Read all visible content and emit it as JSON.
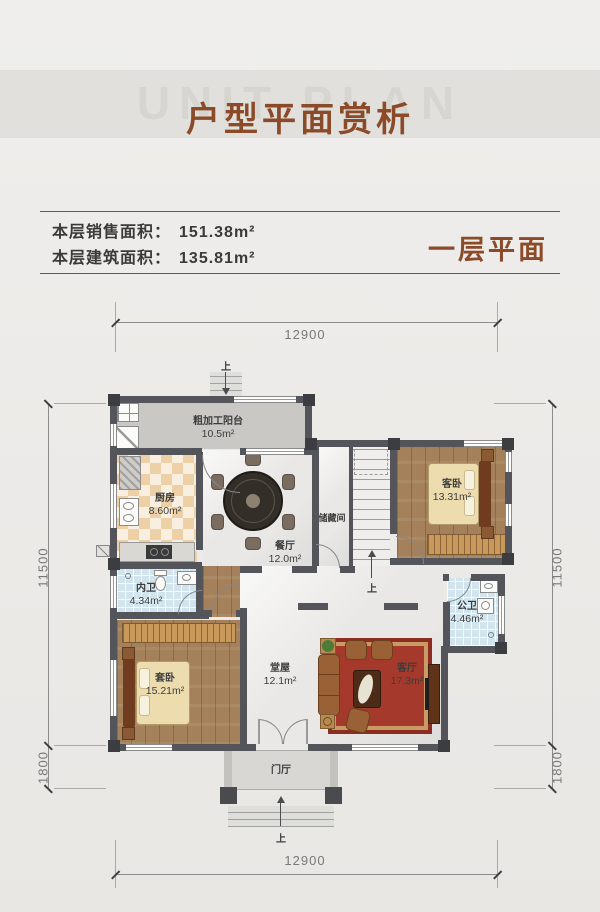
{
  "header": {
    "watermark": "UNIT PLAN",
    "title": "户型平面赏析"
  },
  "info": {
    "sales_label": "本层销售面积：",
    "sales_value": "151.38m²",
    "build_label": "本层建筑面积：",
    "build_value": "135.81m²",
    "tag": "一层平面"
  },
  "rooms": {
    "balcony": {
      "name": "粗加工阳台",
      "area": "10.5m²"
    },
    "kitchen": {
      "name": "厨房",
      "area": "8.60m²"
    },
    "dining": {
      "name": "餐厅",
      "area": "12.0m²"
    },
    "storage": {
      "name": "储藏间"
    },
    "guest_bedroom": {
      "name": "客卧",
      "area": "13.31m²"
    },
    "inner_bath": {
      "name": "内卫",
      "area": "4.34m²"
    },
    "public_bath": {
      "name": "公卫",
      "area": "4.46m²"
    },
    "suite_bedroom": {
      "name": "套卧",
      "area": "15.21m²"
    },
    "main_hall": {
      "name": "堂屋",
      "area": "12.1m²"
    },
    "living_room": {
      "name": "客厅",
      "area": "17.3m²"
    },
    "foyer": {
      "name": "门厅"
    }
  },
  "labels": {
    "up": "上"
  },
  "dims": {
    "top": "12900",
    "bottom": "12900",
    "side_main": "11500",
    "side_sub": "1800"
  },
  "colors": {
    "accent": "#8b4a28",
    "wall": "#54555a",
    "wood_floor": "#a5815b",
    "tile_floor": "#d2e5ef",
    "kitchen_floor": "#f1dcba",
    "carpet": "#a5392b"
  }
}
